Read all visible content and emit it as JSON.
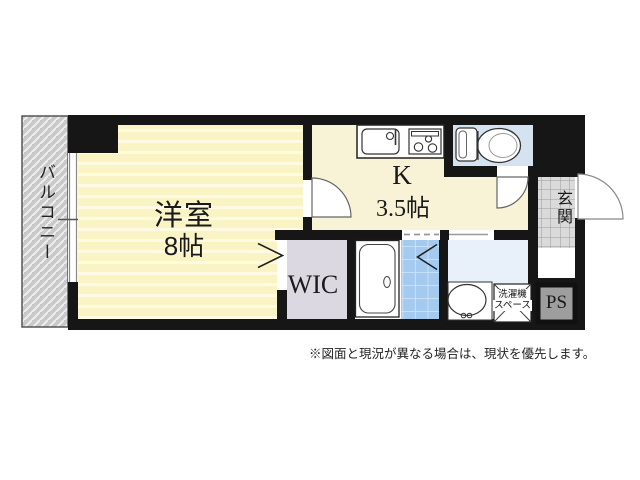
{
  "floorplan": {
    "rooms": {
      "balcony": {
        "label": "バルコニー"
      },
      "western_room": {
        "label": "洋室",
        "size": "8帖"
      },
      "kitchen": {
        "label": "K",
        "size": "3.5帖"
      },
      "wic": {
        "label": "WIC"
      },
      "entrance": {
        "label": "玄関"
      },
      "pipe_space": {
        "label": "PS"
      },
      "laundry_space": {
        "label": "洗濯機スペース",
        "line1": "洗濯機",
        "line2": "スペース"
      }
    },
    "fixtures": [
      "kitchen-sink-icon",
      "gas-stove-icon",
      "toilet-icon",
      "bathtub-icon",
      "washbasin-icon",
      "washing-machine-space-icon",
      "window-icon",
      "door-swing-icon",
      "folding-door-icon"
    ],
    "disclaimer": "※図面と現況が異なる場合は、現状を優先します。",
    "colors": {
      "wall": "#161616",
      "room_stripe_base": "#FAF4C4",
      "room_stripe_light": "#FEFBE2",
      "kitchen_yellow": "#F8F3D6",
      "toilet_blue": "#D5E3F1",
      "washroom_blue": "#E8F1F9",
      "shower_tile_blue": "#A5CAEF",
      "wic_lavender": "#DCD8E1",
      "balcony_gray": "#C9C9C9",
      "entrance_tile_gray": "#DADADA",
      "pipe_space_gray": "#9E9E9E"
    }
  }
}
